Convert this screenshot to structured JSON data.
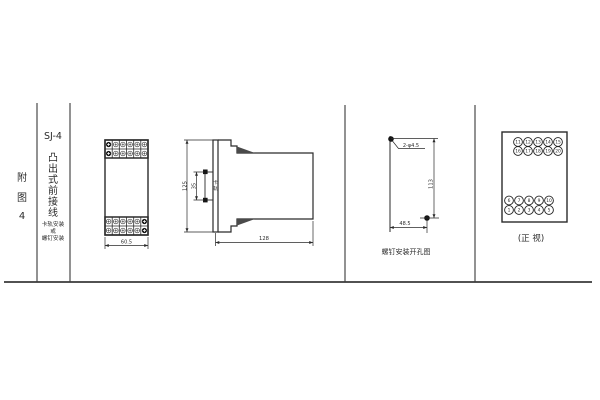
{
  "colors": {
    "line": "#2a2a2a",
    "frame": "#3a3a3a",
    "text": "#2b2b2b"
  },
  "sidebar": {
    "figure_label_chars": [
      "附",
      "图",
      "4"
    ],
    "model": "SJ-4",
    "type_chars": [
      "凸",
      "出",
      "式",
      "前",
      "接",
      "线"
    ],
    "mount_lines": [
      "卡轨安装",
      "或",
      "螺钉安装"
    ]
  },
  "front_view": {
    "width_dim": "60.5"
  },
  "side_view": {
    "height_dim": "125",
    "rail_slot_dim": "35",
    "rail_slot_label_chars": [
      "卡",
      "轨"
    ],
    "depth_dim": "128"
  },
  "drill_view": {
    "hole_note": "2-φ4.5",
    "height_dim": "113",
    "width_dim": "48.5",
    "caption": "螺钉安装开孔图"
  },
  "terminal_view": {
    "top_row1": [
      "11",
      "12",
      "13",
      "14",
      "15"
    ],
    "top_row2": [
      "16",
      "17",
      "18",
      "19",
      "20"
    ],
    "bottom_row1": [
      "6",
      "7",
      "8",
      "9",
      "10"
    ],
    "bottom_row2": [
      "1",
      "2",
      "3",
      "4",
      "5"
    ],
    "caption": "(正 视)"
  }
}
